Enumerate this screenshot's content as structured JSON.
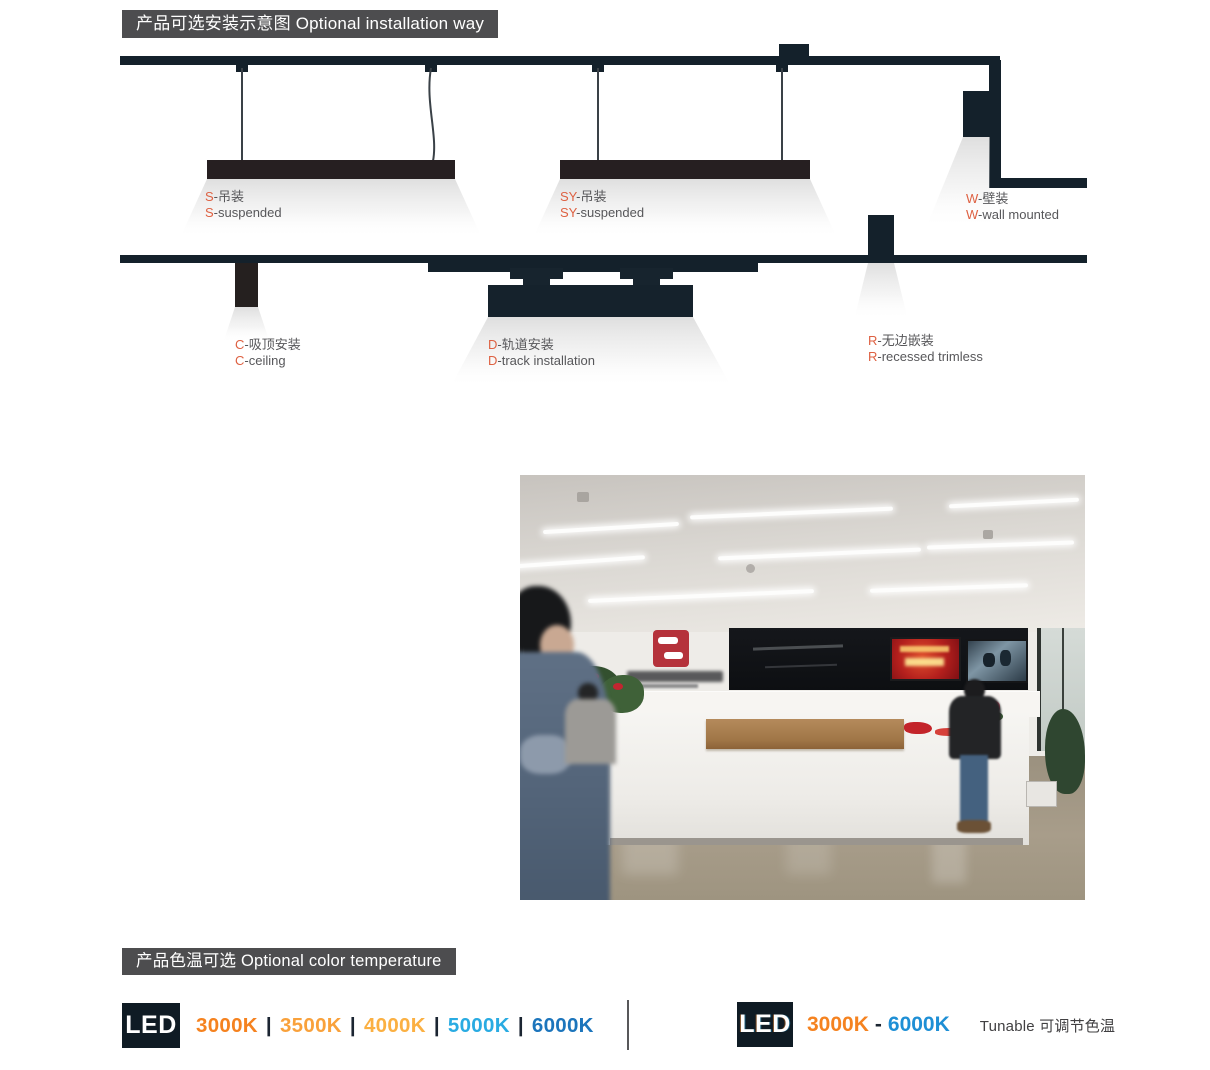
{
  "installation_section": {
    "header": "产品可选安装示意图 Optional installation way",
    "accent_color": "#DE6142",
    "items": [
      {
        "prefix": "S",
        "zh": "-吊装",
        "en_prefix": "S",
        "en": "-suspended"
      },
      {
        "prefix": "SY",
        "zh": "-吊装",
        "en_prefix": "SY",
        "en": "-suspended"
      },
      {
        "prefix": "W",
        "zh": "-壁装",
        "en_prefix": "W",
        "en": "-wall mounted"
      },
      {
        "prefix": "C",
        "zh": "-吸顶安装",
        "en_prefix": "C",
        "en": "-ceiling"
      },
      {
        "prefix": "D",
        "zh": "-轨道安装",
        "en_prefix": "D",
        "en": "-track installation"
      },
      {
        "prefix": "R",
        "zh": "-无边嵌装",
        "en_prefix": "R",
        "en": "-recessed trimless"
      }
    ]
  },
  "color_temperature_section": {
    "header": "产品色温可选 Optional color temperature",
    "led_badge": "LED",
    "separator": "|",
    "separator_color": "#1B2532",
    "fixed_options": [
      {
        "label": "3000K",
        "color": "#F5821F"
      },
      {
        "label": "3500K",
        "color": "#F9A13B"
      },
      {
        "label": "4000K",
        "color": "#FBB042"
      },
      {
        "label": "5000K",
        "color": "#29ABE2"
      },
      {
        "label": "6000K",
        "color": "#1C75BC"
      }
    ],
    "tunable": {
      "from_label": "3000K",
      "from_color": "#F5821F",
      "dash": "-",
      "dash_color": "#1B2532",
      "to_label": "6000K",
      "to_color": "#1E8FD5",
      "note": "Tunable 可调节色温"
    }
  }
}
